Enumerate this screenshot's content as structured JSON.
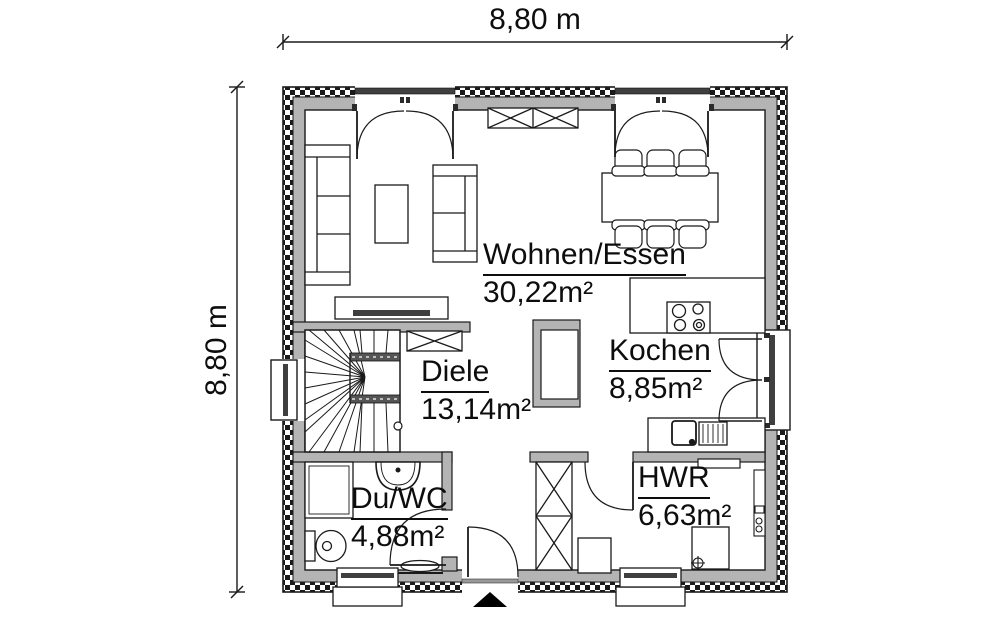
{
  "image_type": "architectural floor plan (ground floor)",
  "dimension_labels": {
    "top": "8,80 m",
    "left": "8,80 m"
  },
  "rooms": [
    {
      "name": "Wohnen/Essen",
      "area": "30,22m²"
    },
    {
      "name": "Kochen",
      "area": "8,85m²"
    },
    {
      "name": "Diele",
      "area": "13,14m²"
    },
    {
      "name": "Du/WC",
      "area": "4,88m²"
    },
    {
      "name": "HWR",
      "area": "6,63m²"
    }
  ],
  "features": {
    "doors": [
      "french-door-living",
      "french-door-dining",
      "terrace-door-kitchen",
      "entrance-door",
      "door-du-wc",
      "door-hwr"
    ],
    "windows": [
      "window-left-wall",
      "window-du-wc",
      "window-hwr"
    ],
    "stairs": "winder-staircase",
    "symbols": [
      "sofa-large",
      "sofa-small",
      "coffee-table",
      "tv-lowboard",
      "sideboard",
      "dining-table",
      "dining-chairs-6",
      "kitchen-counter-cooktop",
      "kitchen-sink-counter",
      "chimney-shaft",
      "hall-wardrobe",
      "entry-wardrobe",
      "shower",
      "washbasin",
      "toilet",
      "radiator",
      "washing-machine",
      "utility-cabinet",
      "utility-shelf",
      "entrance-arrow"
    ]
  },
  "colors": {
    "background": "#ffffff",
    "wall_fill": "#b4b4b4",
    "outline": "#1a1a1a",
    "lintel": "#3f3f3f",
    "stair_stringer": "#555555",
    "text": "#0d0d0d"
  }
}
